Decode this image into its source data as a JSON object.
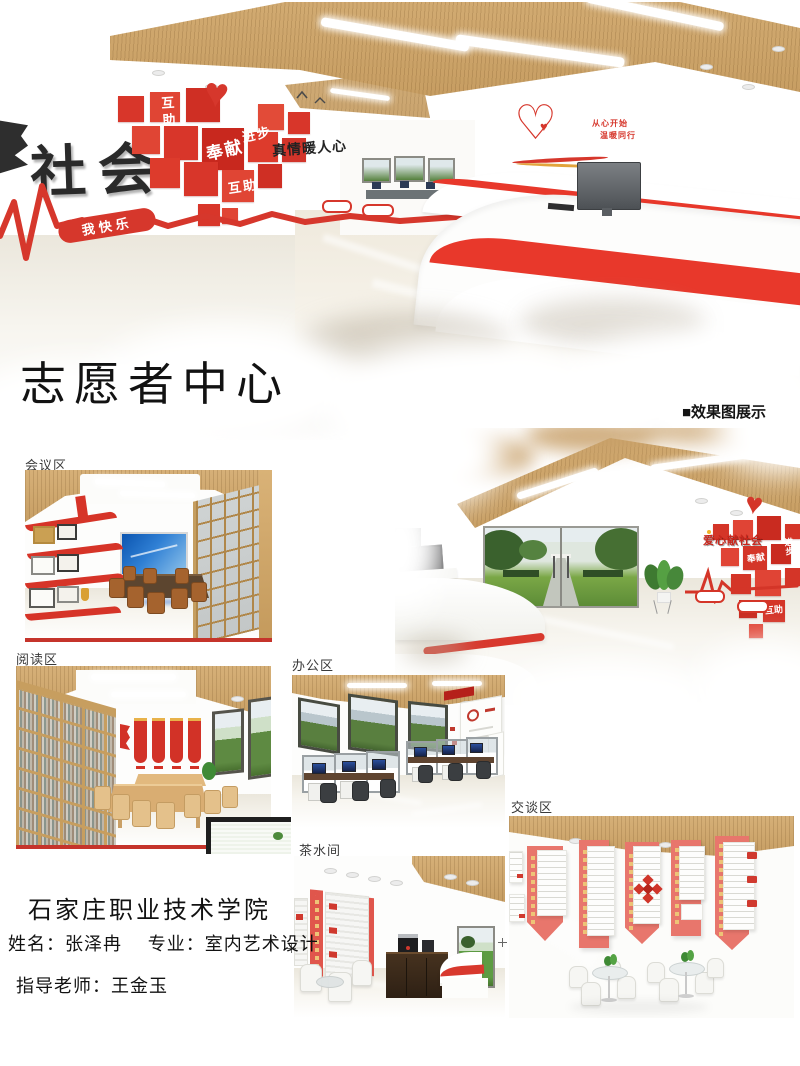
{
  "page": {
    "title": "志愿者中心",
    "render_badge": "■效果图展示"
  },
  "hero": {
    "wall": {
      "society": "社会",
      "mutual_aid_top": "互助",
      "progress": "进步",
      "dedication": "奉献",
      "mutual_aid_bottom": "互助",
      "warm_hearts": "真情暖人心",
      "happy": "我快乐"
    },
    "reception": {
      "slogan_line1": "从心开始",
      "slogan_line2": "温暖同行"
    }
  },
  "entrance": {
    "wall_title": "爱心献社会",
    "tiles": {
      "dedication": "奉献",
      "mutual_aid": "互助",
      "progress": "进步"
    }
  },
  "areas": {
    "meeting": {
      "label": "会议区"
    },
    "reading": {
      "label": "阅读区"
    },
    "office": {
      "label": "办公区"
    },
    "tea": {
      "label": "茶水间"
    },
    "chat": {
      "label": "交谈区"
    }
  },
  "footer": {
    "school": "石家庄职业技术学院",
    "name_major": "姓名：张泽冉　 专业：室内艺术设计",
    "advisor": "指导老师：王金玉"
  },
  "icons": {
    "heart_solid": "♥",
    "heart_outline": "♡"
  },
  "colors": {
    "accent_red": "#d6372c",
    "wood": "#c9a76c"
  }
}
